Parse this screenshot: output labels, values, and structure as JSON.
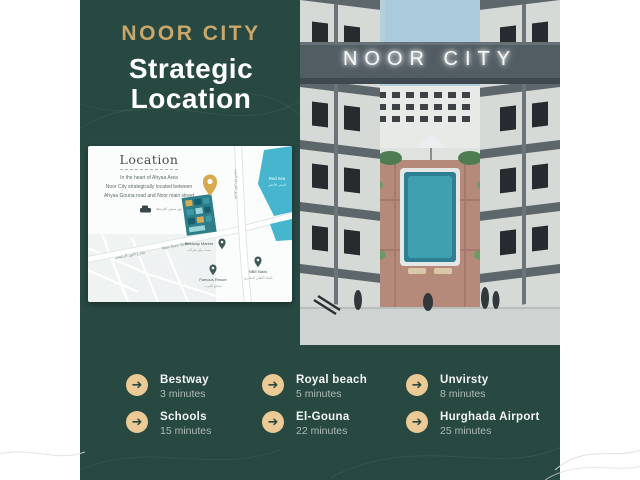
{
  "colors": {
    "flyer_background": "#284842",
    "brand_gold": "#c9a76b",
    "icon_gold": "#ecca96",
    "map_water_blue": "#45b6cd",
    "map_project_teal": "#2e7d8a"
  },
  "header": {
    "brand": "NOOR CITY",
    "headline_line1": "Strategic",
    "headline_line2": "Location"
  },
  "map_card": {
    "title": "Location",
    "desc_line1": "In the heart of Ahyaa Area",
    "desc_line2": "Noor City strategically located between",
    "desc_line3": "Ahyaa Gouna road and Noor main street",
    "water_label_en": "Red Sea",
    "water_label_ar": "البحر الأحمر",
    "main_road_label": "Main Noor Street",
    "main_road_label_ar": "شارع النور الرئيسي",
    "side_road_label_ar": "طريق الغردقة الجونة",
    "project_label_ar": "نور سيتي الغردقة",
    "poi_bestway_en": "Bestway Market",
    "poi_bestway_ar": "بست واي ماركت",
    "poi_resort_en": "Famous Resort",
    "poi_resort_ar": "منتجع العرب",
    "poi_bank_en": "NBE Bank",
    "poi_bank_ar": "البنك الأهلي المصري"
  },
  "render": {
    "sign": "NOOR CITY"
  },
  "distances": [
    {
      "label": "Bestway",
      "time": "3 minutes"
    },
    {
      "label": "Royal beach",
      "time": "5 minutes"
    },
    {
      "label": "Unvirsty",
      "time": "8 minutes"
    },
    {
      "label": "Schools",
      "time": "15 minutes"
    },
    {
      "label": "El-Gouna",
      "time": "22 minutes"
    },
    {
      "label": "Hurghada Airport",
      "time": "25 minutes"
    }
  ]
}
